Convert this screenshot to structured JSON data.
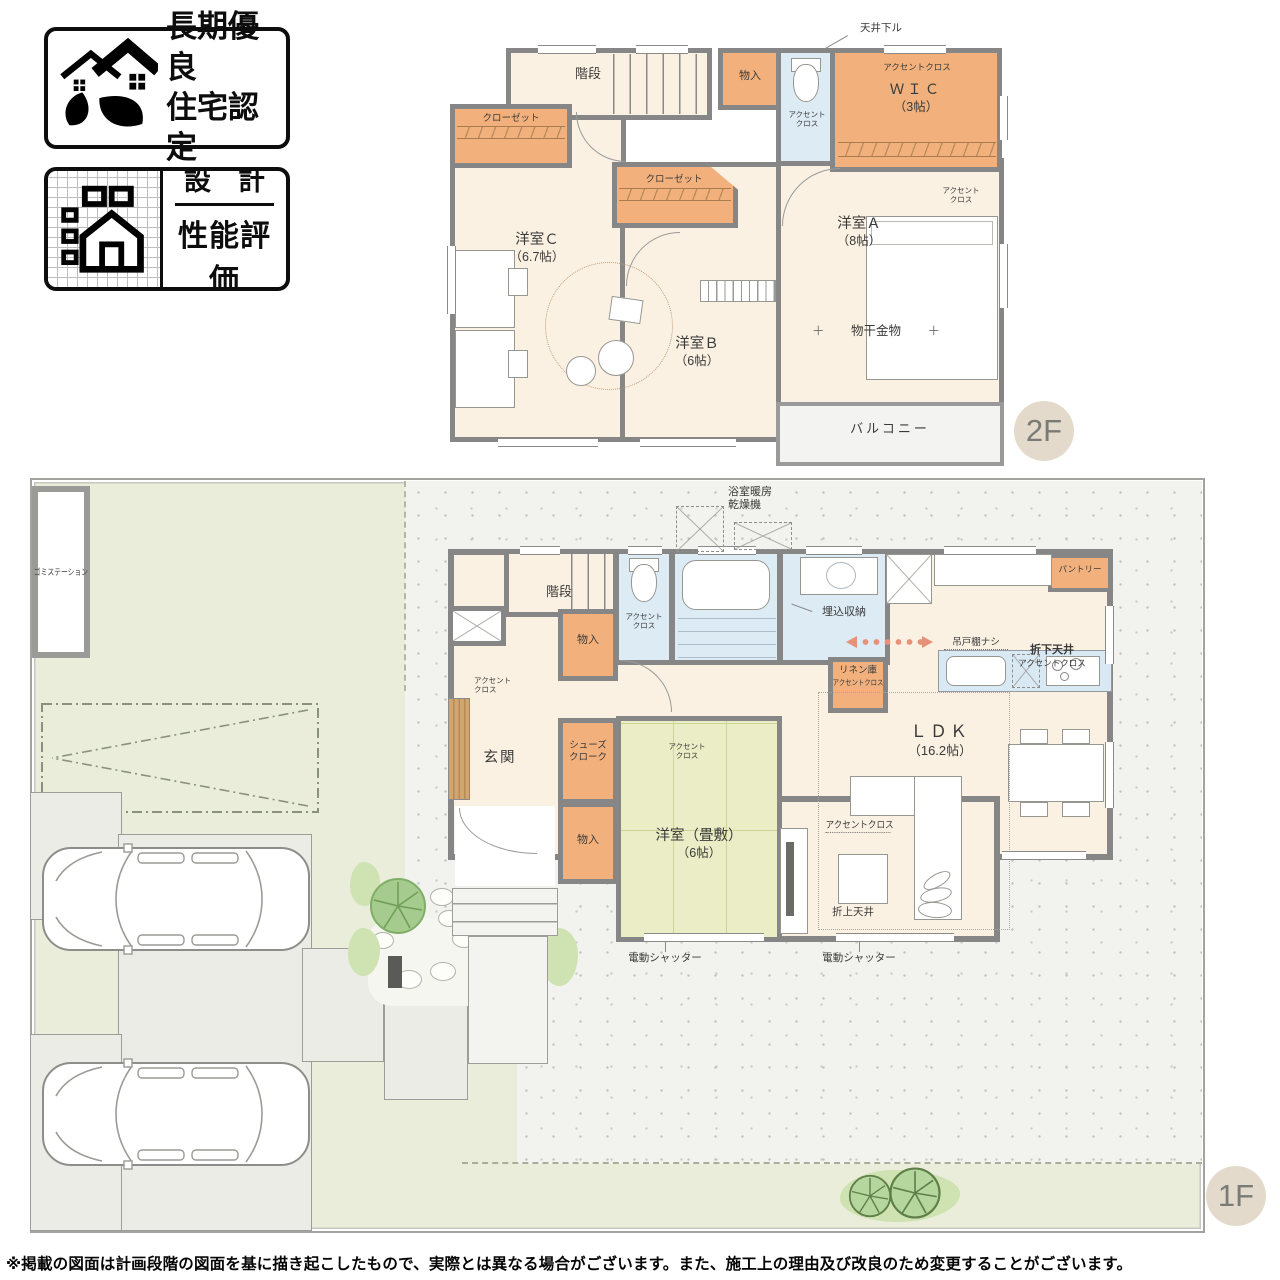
{
  "badges": {
    "longterm": {
      "line1": "長期優良",
      "line2": "住宅認定"
    },
    "design": {
      "top": "設　計",
      "bottom": "性能評価"
    }
  },
  "common": {
    "accent": "アクセントクロス",
    "accent_l1": "アクセント",
    "accent_l2": "クロス",
    "stairs": "階段",
    "storage": "物入",
    "closet": "クローゼット"
  },
  "floor2": {
    "badge": "2F",
    "ceiling_drop": "天井下ル",
    "wic": "ＷＩＣ",
    "wic_size": "（3帖）",
    "room_a": "洋室Ａ",
    "room_a_size": "（8帖）",
    "room_b": "洋室Ｂ",
    "room_b_size": "（6帖）",
    "room_c": "洋室Ｃ",
    "room_c_size": "（6.7帖）",
    "laundry": "物干金物",
    "laundry_mark": "＋",
    "balcony": "バルコニー"
  },
  "floor1": {
    "badge": "1F",
    "bath_heater_l1": "浴室暖房",
    "bath_heater_l2": "乾燥機",
    "recessed_storage": "埋込収納",
    "linen": "リネン庫",
    "pantry": "パントリー",
    "no_cabinet": "吊戸棚ナシ",
    "dropped_ceiling": "折下天井",
    "ldk": "ＬＤＫ",
    "ldk_size": "（16.2帖）",
    "genkan": "玄関",
    "shoe_l1": "シューズ",
    "shoe_l2": "クローク",
    "tatami": "洋室（畳敷）",
    "tatami_size": "（6帖）",
    "raised_ceiling": "折上天井",
    "shutter": "電動シャッター"
  },
  "site": {
    "garbage": "ゴミステーション"
  },
  "disclaimer": "※掲載の図面は計画段階の図面を基に描き起こしたもので、実際とは異なる場合がございます。また、施工上の理由及び改良のため変更することがございます。"
}
